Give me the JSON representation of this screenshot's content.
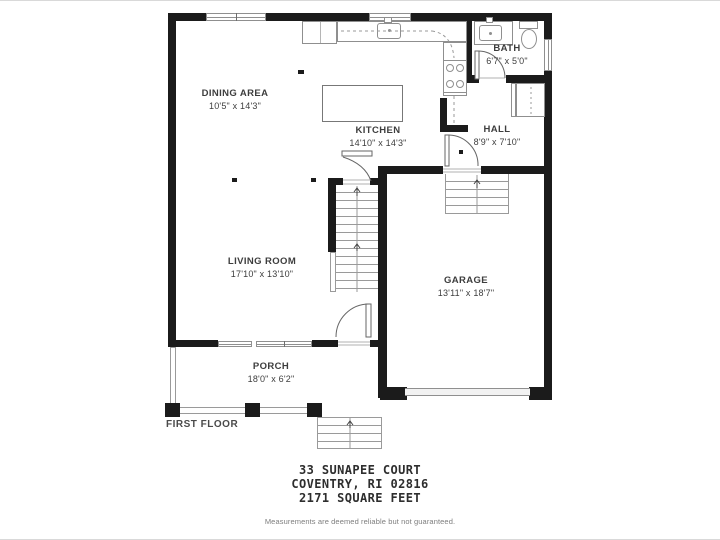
{
  "floorplan": {
    "floor_label": "FIRST FLOOR",
    "rooms": [
      {
        "name": "DINING AREA",
        "dims": "10'5\" x 14'3\""
      },
      {
        "name": "KITCHEN",
        "dims": "14'10\" x 14'3\""
      },
      {
        "name": "BATH",
        "dims": "6'7\" x 5'0\""
      },
      {
        "name": "HALL",
        "dims": "8'9\" x 7'10\""
      },
      {
        "name": "LIVING ROOM",
        "dims": "17'10\" x 13'10\""
      },
      {
        "name": "GARAGE",
        "dims": "13'11\" x 18'7\""
      },
      {
        "name": "PORCH",
        "dims": "18'0\" x 6'2\""
      }
    ],
    "fixtures": [
      "refrigerator",
      "kitchen-sink",
      "kitchen-island",
      "stove",
      "bath-sink",
      "toilet",
      "closet",
      "main-stairs",
      "garage-stairs",
      "porch-steps",
      "garage-door"
    ]
  },
  "footer": {
    "address_line1": "33 SUNAPEE COURT",
    "address_line2": "COVENTRY, RI 02816",
    "address_line3": "2171 SQUARE FEET",
    "disclaimer": "Measurements are deemed reliable but not guaranteed."
  },
  "colors": {
    "wall": "#1b1b1b",
    "line": "#8f8f8f",
    "text": "#3d3d3d"
  }
}
